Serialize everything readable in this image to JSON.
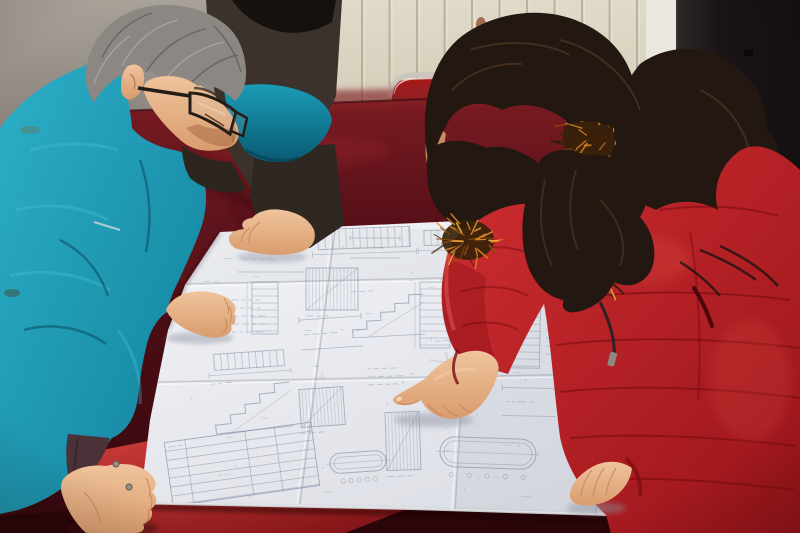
{
  "meta": {
    "type": "photograph",
    "description": "Two colleagues study a large folded engineering blueprint spread on a dark red velvet-covered table: a gray-haired man in a teal work jacket and glasses leans over from the left, a woman in a red fur-trimmed winter coat points at a detail with her index finger, and a third partially visible person in a dark jacket rests a hand on the sheet."
  },
  "colors": {
    "wall_cream": "#d9d2c0",
    "wall_groove": "#b0a58c",
    "wall_gray": "#958f86",
    "wall_light_strip": "#eae7e0",
    "door_dark": "#171213",
    "stain_rust": "#8a4a22",
    "chair_metal": "#cac6bd",
    "chair_seat": "#a31b1d",
    "velvet_deep": "#470c13",
    "velvet_sheen": "#8c2127",
    "velvet_bright": "#c22f33",
    "paper": "#e9eaee",
    "ink": "#7e86a0",
    "teal": "#1d9db8",
    "teal_dark": "#0e7a93",
    "dark_jacket": "#3a322b",
    "dark_hair": "#17110d",
    "man_hair_dark": "#4e4a45",
    "man_hair_light": "#b9b6b1",
    "skin": "#e2aa80",
    "skin_shadow": "#c08055",
    "skin_light": "#f4cda6",
    "woman_hair": "#221711",
    "woman_hair_light": "#6a4a2e",
    "fur_orange": "#d8821f",
    "fur_amber": "#f0a63c",
    "fur_brown": "#8a4a12",
    "fur_dark": "#342108",
    "coat_red": "#c4272e",
    "coat_red_dark": "#8d1217",
    "lining_cuff": "#4b3138",
    "glasses_frame": "#241c16"
  },
  "scene": {
    "wall": {
      "label": "cream paneled wall",
      "grooves": {
        "x0": 252,
        "x1": 648,
        "step": 27.5,
        "y0": 0,
        "y1": 102
      }
    },
    "door": {
      "label": "dark door at right"
    },
    "chair": {
      "label": "metal-frame chair with red seat behind table"
    },
    "table": {
      "label": "table draped in dark red velvet"
    },
    "people": [
      {
        "id": "man-left",
        "label": "gray-haired man in teal jacket with glasses"
      },
      {
        "id": "person-behind",
        "label": "partially visible person in dark jacket"
      },
      {
        "id": "woman-right",
        "label": "woman in red fur-trimmed coat pointing at the drawing"
      }
    ],
    "fur_patches": [
      {
        "layer": "hood",
        "cx": 615,
        "cy": 136,
        "rx": 52,
        "ry": 40,
        "n": 90,
        "seed": 3
      },
      {
        "layer": "chest",
        "cx": 468,
        "cy": 240,
        "rx": 26,
        "ry": 20,
        "n": 38,
        "seed": 5
      },
      {
        "layer": "chest",
        "cx": 598,
        "cy": 276,
        "rx": 20,
        "ry": 13,
        "n": 24,
        "seed": 9
      }
    ],
    "blueprint": {
      "label": "large folded construction blueprint",
      "scatter": {
        "seed": 7,
        "count": 70,
        "x0": 185,
        "y0": 236,
        "x1": 655,
        "y1": 498
      },
      "blocks": [
        {
          "t": "dims",
          "x": 238,
          "y": 246,
          "w": 66,
          "h": 26,
          "r": 0
        },
        {
          "t": "hladder",
          "x": 318,
          "y": 228,
          "w": 92,
          "h": 20,
          "r": -2
        },
        {
          "t": "hladder",
          "x": 424,
          "y": 230,
          "w": 58,
          "h": 15,
          "r": -1
        },
        {
          "t": "vladder",
          "x": 252,
          "y": 282,
          "w": 26,
          "h": 52,
          "r": 0
        },
        {
          "t": "hatch",
          "x": 306,
          "y": 268,
          "w": 52,
          "h": 42,
          "r": 0
        },
        {
          "t": "stair",
          "x": 352,
          "y": 296,
          "w": 72,
          "h": 40,
          "r": -3
        },
        {
          "t": "vladder",
          "x": 420,
          "y": 282,
          "w": 30,
          "h": 66,
          "r": 0
        },
        {
          "t": "dims",
          "x": 300,
          "y": 318,
          "w": 62,
          "h": 30,
          "r": -4
        },
        {
          "t": "text",
          "x": 232,
          "y": 300,
          "w": 46,
          "h": 34,
          "r": 0
        },
        {
          "t": "stair",
          "x": 214,
          "y": 386,
          "w": 78,
          "h": 44,
          "r": -6
        },
        {
          "t": "hatch",
          "x": 300,
          "y": 388,
          "w": 44,
          "h": 38,
          "r": -4
        },
        {
          "t": "table",
          "x": 168,
          "y": 432,
          "w": 148,
          "h": 64,
          "r": -8
        },
        {
          "t": "hatch",
          "x": 386,
          "y": 412,
          "w": 34,
          "h": 58,
          "r": -2
        },
        {
          "t": "oval",
          "x": 440,
          "y": 438,
          "w": 96,
          "h": 30,
          "r": 2
        },
        {
          "t": "vladder",
          "x": 506,
          "y": 296,
          "w": 34,
          "h": 72,
          "r": 1
        },
        {
          "t": "dims",
          "x": 502,
          "y": 388,
          "w": 54,
          "h": 28,
          "r": 1
        },
        {
          "t": "table",
          "x": 588,
          "y": 428,
          "w": 72,
          "h": 76,
          "r": 3
        },
        {
          "t": "hladder",
          "x": 522,
          "y": 238,
          "w": 62,
          "h": 16,
          "r": 0
        },
        {
          "t": "stair",
          "x": 436,
          "y": 346,
          "w": 60,
          "h": 34,
          "r": -2
        },
        {
          "t": "dims",
          "x": 350,
          "y": 238,
          "w": 50,
          "h": 20,
          "r": 0
        },
        {
          "t": "text",
          "x": 546,
          "y": 330,
          "w": 40,
          "h": 30,
          "r": 0
        },
        {
          "t": "hladder",
          "x": 214,
          "y": 352,
          "w": 70,
          "h": 16,
          "r": -4
        },
        {
          "t": "vladder",
          "x": 636,
          "y": 300,
          "w": 26,
          "h": 60,
          "r": 2
        },
        {
          "t": "text",
          "x": 368,
          "y": 368,
          "w": 52,
          "h": 22,
          "r": -2
        },
        {
          "t": "oval",
          "x": 330,
          "y": 452,
          "w": 56,
          "h": 20,
          "r": -4
        }
      ]
    }
  }
}
